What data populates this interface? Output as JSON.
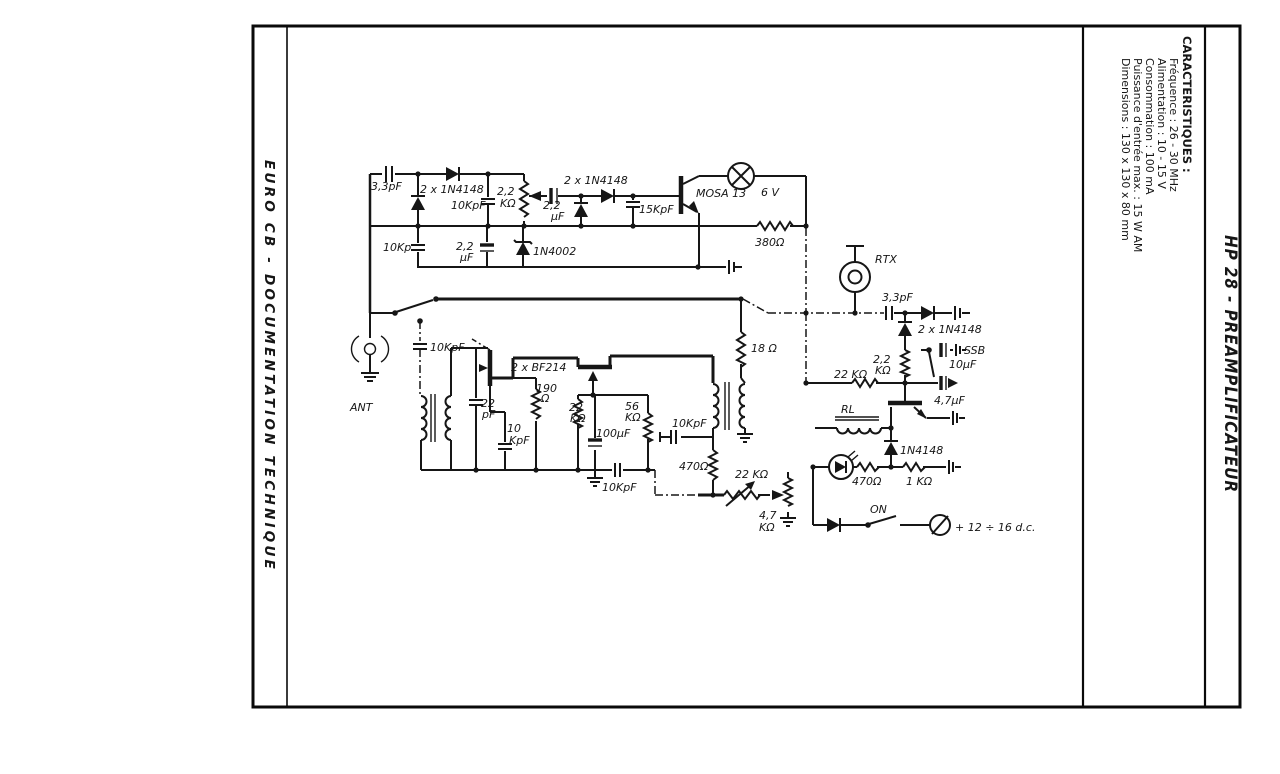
{
  "page": {
    "side_left": "EURO CB - DOCUMENTATION TECHNIQUE",
    "side_right_title": "HP 28 - PREAMPLIFICATEUR",
    "characteristics": {
      "title": "CARACTERISTIQUES :",
      "items": [
        "Fréquence : 26 - 30 MHz",
        "Alimentation : 10 - 15 V",
        "Consommation : 100 mA",
        "Puissance d'entrée max. : 15 W AM",
        "Dimensions : 130 x 130 x 80 mm"
      ]
    }
  },
  "schematic": {
    "ink_color": "#161616",
    "power_label": "+ 12 ÷ 16 d.c.",
    "labels": [
      {
        "t": "3,3pF",
        "x": 371,
        "y": 190
      },
      {
        "t": "2 x 1N4148",
        "x": 420,
        "y": 193
      },
      {
        "t": "10KpF",
        "x": 451,
        "y": 209
      },
      {
        "t": "2,2",
        "x": 497,
        "y": 195
      },
      {
        "t": "KΩ",
        "x": 500,
        "y": 207
      },
      {
        "t": "2,2",
        "x": 543,
        "y": 209
      },
      {
        "t": "µF",
        "x": 551,
        "y": 220
      },
      {
        "t": "2 x 1N4148",
        "x": 564,
        "y": 184
      },
      {
        "t": "15KpF",
        "x": 639,
        "y": 213
      },
      {
        "t": "MOSA 13",
        "x": 696,
        "y": 197,
        "fs": 12
      },
      {
        "t": "6 V",
        "x": 761,
        "y": 196,
        "fs": 14
      },
      {
        "t": "380Ω",
        "x": 755,
        "y": 246,
        "fs": 12
      },
      {
        "t": "10Kp",
        "x": 383,
        "y": 251
      },
      {
        "t": "2,2",
        "x": 456,
        "y": 250
      },
      {
        "t": "µF",
        "x": 460,
        "y": 261
      },
      {
        "t": "1N4002",
        "x": 533,
        "y": 255,
        "fs": 12
      },
      {
        "t": "ANT",
        "x": 350,
        "y": 411,
        "fs": 14
      },
      {
        "t": "10KpF",
        "x": 430,
        "y": 351
      },
      {
        "t": "2 x BF214",
        "x": 511,
        "y": 371
      },
      {
        "t": "22",
        "x": 481,
        "y": 407
      },
      {
        "t": "pF",
        "x": 482,
        "y": 418
      },
      {
        "t": "190",
        "x": 536,
        "y": 392
      },
      {
        "t": "Ω",
        "x": 541,
        "y": 402
      },
      {
        "t": "22",
        "x": 569,
        "y": 411
      },
      {
        "t": "KΩ",
        "x": 570,
        "y": 422
      },
      {
        "t": "10",
        "x": 507,
        "y": 432
      },
      {
        "t": "KpF",
        "x": 509,
        "y": 444
      },
      {
        "t": "100µF",
        "x": 596,
        "y": 437
      },
      {
        "t": "56",
        "x": 625,
        "y": 410
      },
      {
        "t": "KΩ",
        "x": 625,
        "y": 421
      },
      {
        "t": "10KpF",
        "x": 602,
        "y": 491
      },
      {
        "t": "18 Ω",
        "x": 751,
        "y": 352
      },
      {
        "t": "10KpF",
        "x": 672,
        "y": 427
      },
      {
        "t": "470Ω",
        "x": 679,
        "y": 470
      },
      {
        "t": "22 KΩ",
        "x": 735,
        "y": 478
      },
      {
        "t": "4,7",
        "x": 759,
        "y": 519
      },
      {
        "t": "KΩ",
        "x": 759,
        "y": 531
      },
      {
        "t": "RTX",
        "x": 875,
        "y": 263,
        "fs": 16
      },
      {
        "t": "3,3pF",
        "x": 882,
        "y": 301
      },
      {
        "t": "2 x 1N4148",
        "x": 918,
        "y": 333
      },
      {
        "t": "2,2",
        "x": 873,
        "y": 363
      },
      {
        "t": "KΩ",
        "x": 875,
        "y": 374
      },
      {
        "t": "22 KΩ",
        "x": 834,
        "y": 378
      },
      {
        "t": "SSB",
        "x": 964,
        "y": 354,
        "fs": 12
      },
      {
        "t": "10µF",
        "x": 949,
        "y": 368
      },
      {
        "t": "4,7µF",
        "x": 934,
        "y": 404
      },
      {
        "t": "RL",
        "x": 841,
        "y": 413,
        "fs": 12
      },
      {
        "t": "1N4148",
        "x": 900,
        "y": 454
      },
      {
        "t": "470Ω",
        "x": 852,
        "y": 485
      },
      {
        "t": "1 KΩ",
        "x": 906,
        "y": 485
      },
      {
        "t": "ON",
        "x": 870,
        "y": 513
      },
      {
        "t": "+ 12 ÷ 16 d.c.",
        "x": 955,
        "y": 531,
        "fs": 13
      }
    ]
  }
}
